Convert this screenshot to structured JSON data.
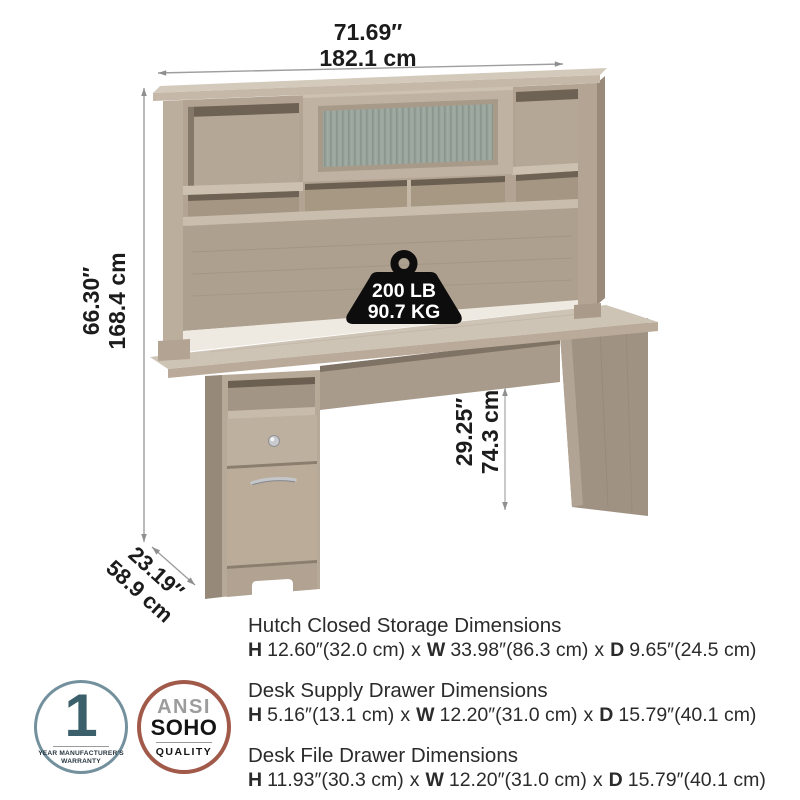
{
  "product_illustration": {
    "overall_width": {
      "in": "71.69″",
      "cm": "182.1 cm"
    },
    "overall_height": {
      "in": "66.30″",
      "cm": "168.4 cm"
    },
    "desk_height": {
      "in": "29.25″",
      "cm": "74.3 cm"
    },
    "overall_depth": {
      "in": "23.19″",
      "cm": "58.9 cm"
    },
    "weight_capacity": {
      "lb": "200 LB",
      "kg": "90.7 KG"
    },
    "weight_icon": "kettlebell-weight-icon"
  },
  "specs": [
    {
      "title": "Hutch Closed Storage Dimensions",
      "h_key": "H",
      "h_val": "12.60″(32.0 cm)",
      "sep1": "x",
      "w_key": "W",
      "w_val": "33.98″(86.3 cm)",
      "sep2": "x",
      "d_key": "D",
      "d_val": "9.65″(24.5 cm)"
    },
    {
      "title": "Desk Supply Drawer Dimensions",
      "h_key": "H",
      "h_val": "5.16″(13.1 cm)",
      "sep1": "x",
      "w_key": "W",
      "w_val": "12.20″(31.0 cm)",
      "sep2": "x",
      "d_key": "D",
      "d_val": "15.79″(40.1 cm)"
    },
    {
      "title": "Desk File Drawer Dimensions",
      "h_key": "H",
      "h_val": "11.93″(30.3 cm)",
      "sep1": "x",
      "w_key": "W",
      "w_val": "12.20″(31.0 cm)",
      "sep2": "x",
      "d_key": "D",
      "d_val": "15.79″(40.1 cm)"
    }
  ],
  "badges": {
    "warranty": {
      "number": "1",
      "caption_line1": "YEAR MANUFACTURER'S",
      "caption_line2": "WARRANTY"
    },
    "quality": {
      "line1": "ANSI",
      "line2": "SOHO",
      "line3": "QUALITY"
    }
  },
  "colors": {
    "wood_light": "#cec4b6",
    "wood_mid": "#b7a897",
    "wood_dark": "#998a7a",
    "glass": "#9aa59d",
    "dimension_line": "#9e9e9e",
    "weight_icon": "#0d0d0d",
    "warranty_accent": "#73909d",
    "quality_accent": "#a15a49"
  }
}
